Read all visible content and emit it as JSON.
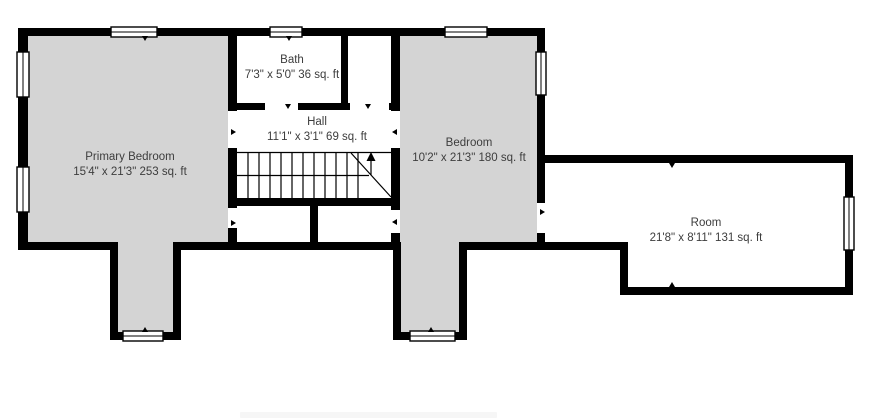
{
  "plan": {
    "colors": {
      "background": "#ffffff",
      "wall": "#000000",
      "room_fill": "#d4d4d4",
      "text": "#3d3d3d"
    },
    "rooms": [
      {
        "name": "Primary Bedroom",
        "dims": "15'4\" x 21'3\" 253 sq. ft"
      },
      {
        "name": "Bath",
        "dims": "7'3\" x 5'0\" 36 sq. ft"
      },
      {
        "name": "Hall",
        "dims": "11'1\" x 3'1\" 69 sq. ft"
      },
      {
        "name": "Bedroom",
        "dims": "10'2\" x 21'3\" 180 sq. ft"
      },
      {
        "name": "Room",
        "dims": "21'8\" x 8'11\" 131 sq. ft"
      }
    ]
  }
}
